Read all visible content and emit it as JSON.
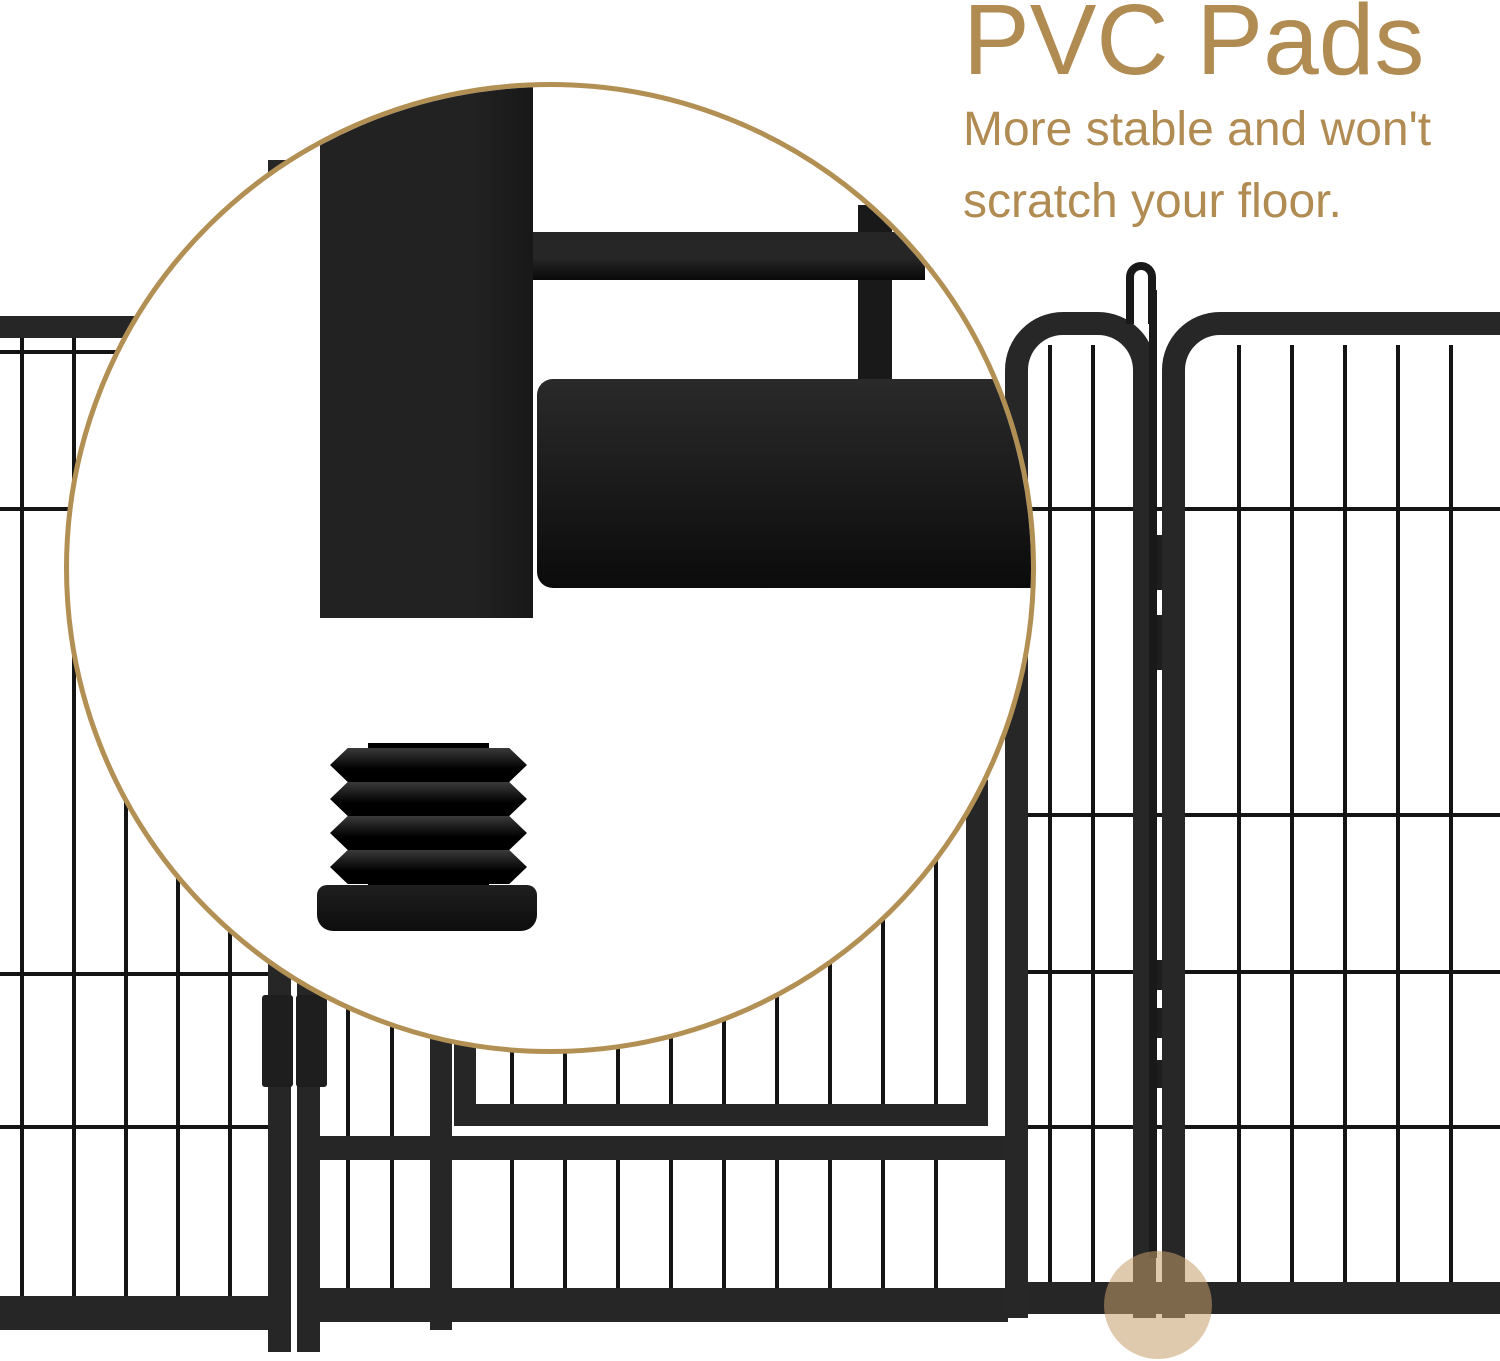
{
  "page": {
    "background": "#ffffff",
    "width": 1500,
    "height": 1361
  },
  "callout": {
    "title": "PVC Pads",
    "subtitle_line1": "More stable and won't",
    "subtitle_line2": "scratch your floor."
  },
  "colors": {
    "accent_text": "#b18c52",
    "magnifier_border": "#b29054",
    "highlight_fill": "rgba(198,158,108,0.55)",
    "fence_frame": "#262626",
    "fence_wire": "#141414",
    "metal_dark": "#1d1d1d"
  },
  "figure": {
    "magnifier_icon": "magnifier-callout-circle",
    "pad_icon": "pvc-pad-plug",
    "hook_icon": "latch-hook",
    "highlight_icon": "pad-foot-highlight"
  }
}
